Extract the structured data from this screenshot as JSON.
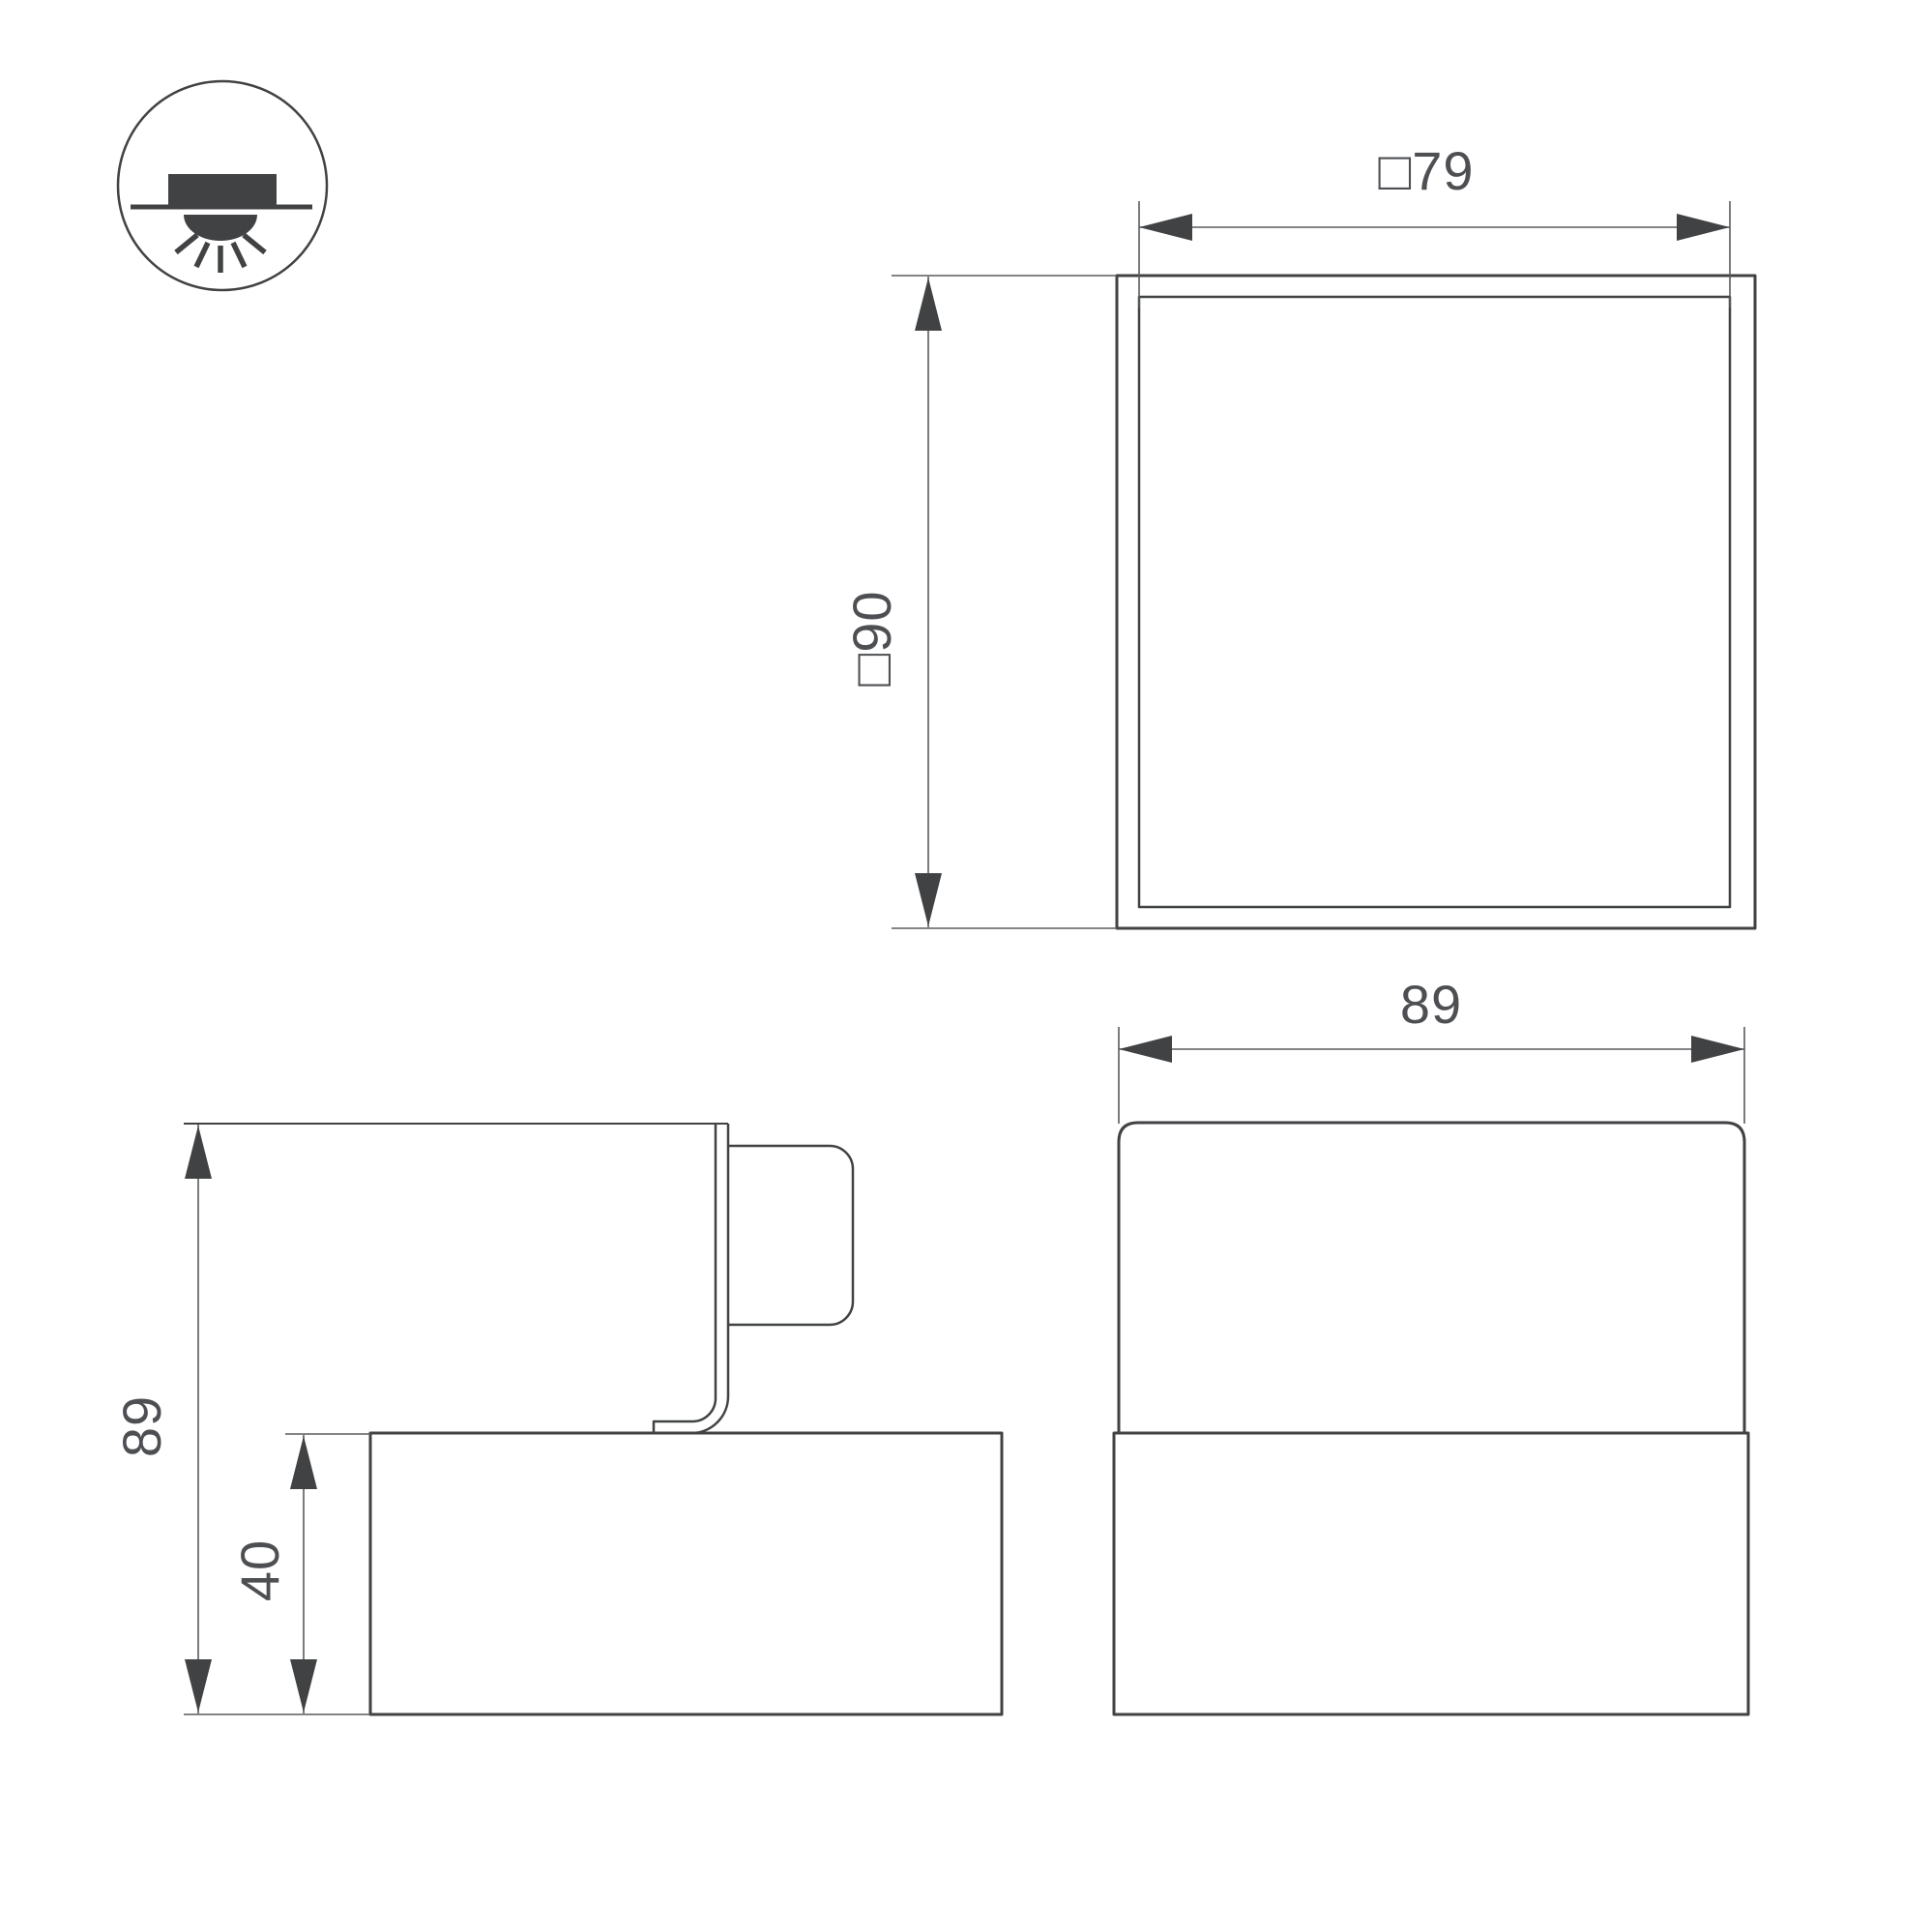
{
  "colors": {
    "line": "#404244",
    "thin": "#595b5e",
    "text": "#4d4f52",
    "bg": "#ffffff"
  },
  "icon": {
    "name": "recessed-downlight-mounting-icon"
  },
  "views": {
    "top": {
      "width_dim": "□79",
      "height_dim": "□90"
    },
    "side": {
      "total_height_dim": "89",
      "base_height_dim": "40"
    },
    "front": {
      "width_dim": "89"
    }
  }
}
